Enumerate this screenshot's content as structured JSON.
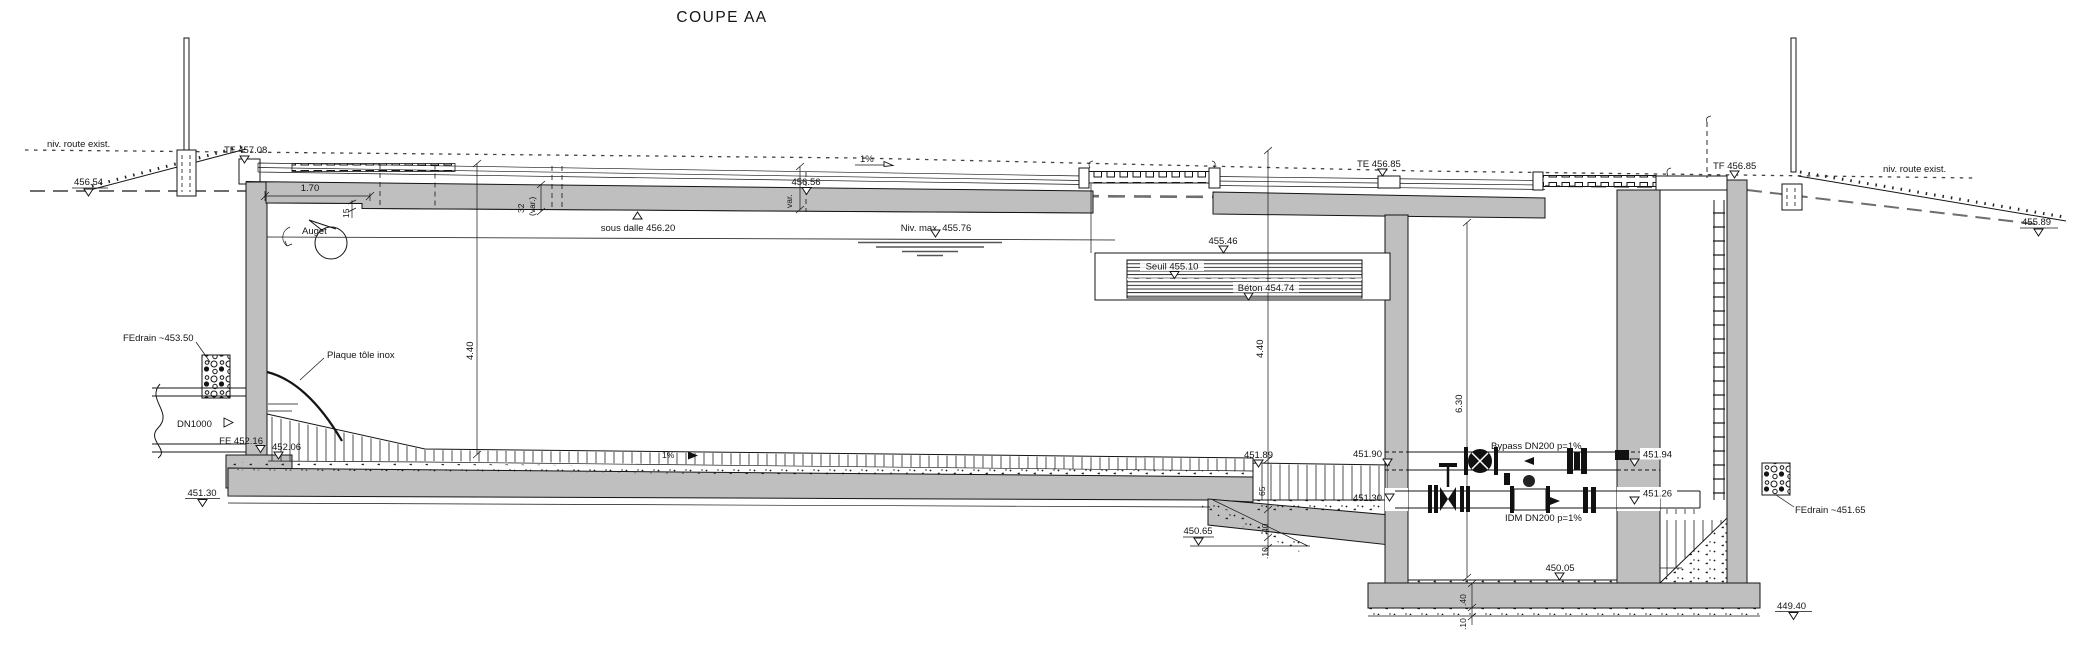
{
  "title": "COUPE AA",
  "colors": {
    "concrete": "#bfbfbf",
    "line": "#141414",
    "ground_dash": "#6e6e6e"
  },
  "terrain": {
    "route_left": "niv. route exist.",
    "route_right": "niv. route exist.",
    "lvl_456_54": "456.54",
    "lvl_455_89": "455.89"
  },
  "roof": {
    "tf_left": "TF 457.08",
    "lvl_456_56": "456.56",
    "slope": "1%",
    "dim_1_70": "1.70",
    "dim_15": "15",
    "dim_32": "32",
    "dim_32_var": "(var.)",
    "dim_var": "var.",
    "sous_dalle": "sous dalle 456.20",
    "te_mid": "TE 456.85",
    "tf_right": "TF 456.85"
  },
  "tank": {
    "auget": "Auget",
    "niv_max": "Niv. max. 455.76",
    "dim_h_left": "4.40",
    "dim_h_right": "4.40",
    "floor_slope": "1%",
    "lvl_451_89": "451.89",
    "plaque": "Plaque tôle inox",
    "fedrain_left": "FEdrain ~453.50"
  },
  "inlet": {
    "dn1000": "DN1000",
    "fe_452_16": "FE 452.16",
    "lvl_452_06": "452.06",
    "lvl_451_30": "451.30"
  },
  "weir": {
    "lvl_455_46": "455.46",
    "seuil": "Seuil 455.10",
    "beton": "Béton 454.74"
  },
  "chamber": {
    "dim_6_30": "6.30",
    "lvl_451_90": "451.90",
    "lvl_451_94": "451.94",
    "bypass": "Bypass DN200 p=1%",
    "lvl_451_30": "451.30",
    "lvl_451_26": "451.26",
    "idm": "IDM DN200 p=1%",
    "lvl_450_05": "450.05",
    "lvl_450_65": "450.65",
    "lvl_449_40": "449.40",
    "dim_65": "65",
    "dim_40": "40",
    "dim_10": ".10",
    "dim_40b": ".40",
    "dim_10b": ".10",
    "fedrain_right": "FEdrain ~451.65"
  }
}
